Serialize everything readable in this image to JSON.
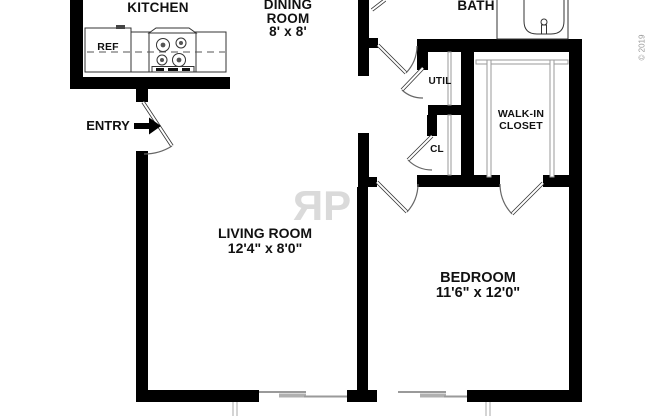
{
  "labels": {
    "kitchen": "KITCHEN",
    "dining_line1": "DINING",
    "dining_line2": "ROOM",
    "dining_dims": "8' x 8'",
    "bath": "BATH",
    "util": "UTIL",
    "closet": "CL",
    "walkin_line1": "WALK-IN",
    "walkin_line2": "CLOSET",
    "living": "LIVING ROOM",
    "living_dims": "12'4\" x 8'0\"",
    "bedroom": "BEDROOM",
    "bedroom_dims": "11'6\" x 12'0\"",
    "entry": "ENTRY",
    "ref": "REF"
  },
  "watermark": {
    "letter1": "R",
    "letter2": "P"
  },
  "copyright": "© 2019",
  "colors": {
    "wall": "#000000",
    "thin_line": "#333333",
    "fixture_gray": "#9a9a9a",
    "sliding_panel_gray": "#b0b0b0",
    "watermark_gray": "#dadada",
    "copyright_gray": "#9a9a9a",
    "background": "#ffffff"
  }
}
